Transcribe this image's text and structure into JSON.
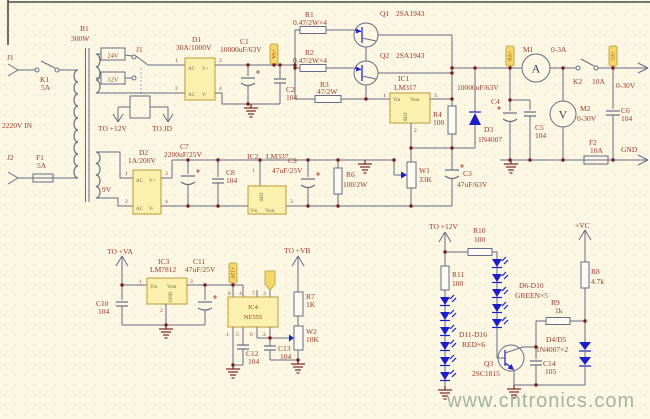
{
  "watermark": "www.cntronics.com",
  "colors": {
    "background": "#fbf7e3",
    "grid_dot": "#d9cdb2",
    "wire": "#6a6a88",
    "label": "#9b3a28",
    "component_fill": "#fbf0ad",
    "component_stroke": "#bb9c33",
    "semiconductor_blue": "#1a1fc8",
    "junction": "#7a1c1c",
    "net_tag_fill": "#f3d869",
    "net_tag_text": "#b23226",
    "watermark_color": "#96a892"
  },
  "pins": {
    "p1": "1",
    "p2": "2",
    "p3": "3",
    "p4": "4",
    "p5": "5",
    "p6": "6",
    "p7": "7",
    "p8": "8"
  },
  "pin_labels": {
    "ac": "AC",
    "vplus": "V+",
    "vminus": "V-",
    "vin": "Vin",
    "vout": "Vout",
    "adj": "ADJ",
    "gnd": "GND"
  },
  "input": {
    "j1": "J1",
    "k1": "K1",
    "k1_val": "5A",
    "mains": "2220V IN",
    "j2": "J2",
    "f1": "F1",
    "f1_val": "5A",
    "b1": "B1",
    "b1_val": "300W",
    "tap_24v": "24V",
    "tap_12v": "12V",
    "tap_9v": "9V",
    "relay": "J1",
    "to_plus12v": "TO +12V",
    "to_jd": "TO JD"
  },
  "rectifier": {
    "d1": "D1",
    "d1_val": "30A/1000V",
    "c1": "C1",
    "c1_val": "10000uF/63V",
    "c2": "C2",
    "c2_val": "104",
    "tag_va": "+VA",
    "d2": "D2",
    "d2_val": "1A/200V",
    "c7": "C7",
    "c7_val": "2200uF/25V",
    "c8": "C8",
    "c8_val": "104"
  },
  "regulator": {
    "r1": "R1",
    "r1_val": "0.47/2W×4",
    "r2": "R2",
    "r2_val": "0.47/2W×4",
    "r3": "R3",
    "r3_val": "47/2W",
    "q1": "Q1",
    "q1_val": "2SA1943",
    "q2": "Q2",
    "q2_val": "2SA1943",
    "ic1": "IC1",
    "ic1_val": "LM317",
    "r4": "R4",
    "r4_val": "100",
    "d3": "D3",
    "d3_val": "1N4007",
    "c4": "C4",
    "c4_val": "10000uF/63V",
    "c5": "C5",
    "c5_val": "104",
    "w1": "W1",
    "w1_val": "33K",
    "c3": "C3",
    "c3_val": "47uF/63V",
    "ic2": "IC2",
    "ic2_val": "LM337",
    "c9": "C9",
    "c9_val": "47uF/25V",
    "r6": "R6",
    "r6_val": "100/2W"
  },
  "output": {
    "tag_vb": "+VB",
    "tag_vc": "+VC",
    "m1": "M1",
    "m1_val": "0-3A",
    "m1_letter": "A",
    "k2": "K2",
    "k2_val": "10A",
    "range": "0-30V",
    "m2": "M2",
    "m2_val": "0-30V",
    "m2_letter": "V",
    "c6": "C6",
    "c6_val": "104",
    "f2": "F2",
    "f2_val": "10A",
    "gnd": "GND"
  },
  "aux": {
    "to_va": "TO +VA",
    "ic3": "IC3",
    "ic3_val": "LM7812",
    "c10": "C10",
    "c10_val": "104",
    "c11": "C11",
    "c11_val": "47uF/25V",
    "tag_12v": "+12V",
    "ic4": "IC4",
    "ic4_val": "NE555",
    "c12": "C12",
    "c12_val": "104",
    "c13": "C13",
    "c13_val": "104",
    "to_vb": "TO +VB",
    "r7": "R7",
    "r7_val": "1K",
    "w2": "W2",
    "w2_val": "10K"
  },
  "led": {
    "to_12v": "TO +12V",
    "r10": "R10",
    "r10_val": "100",
    "r11": "R11",
    "r11_val": "100",
    "d6_10": "D6-D10",
    "d6_10_val": "GREEN×5",
    "d11_16": "D11-D16",
    "d11_16_val": "RED×6",
    "vc": "+VC",
    "r8": "R8",
    "r8_val": "4.7k",
    "r9": "R9",
    "r9_val": "1k",
    "d4_5": "D4/D5",
    "d4_5_val": "1N4007×2",
    "c14": "C14",
    "c14_val": "105",
    "q3": "Q3",
    "q3_val": "2SC1815"
  }
}
